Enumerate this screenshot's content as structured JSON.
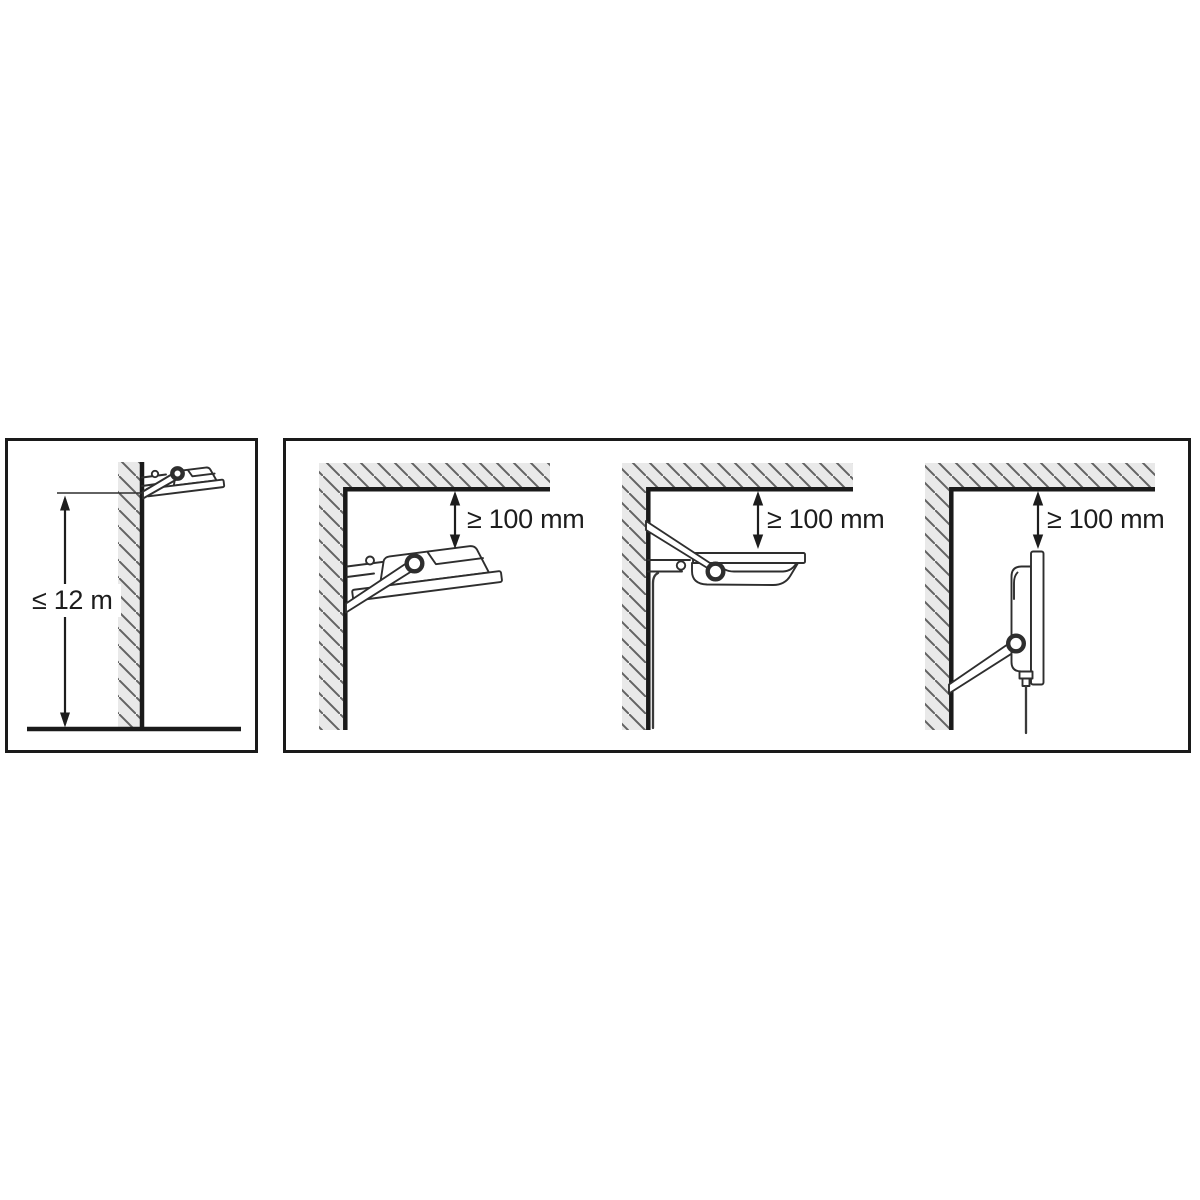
{
  "diagram": {
    "type": "floodlight-installation-clearance-diagram",
    "colors": {
      "background": "#ffffff",
      "outline": "#1a1a1a",
      "drawing_line": "#2e2e2e",
      "wall_fill": "#e9e9e9",
      "hatch_line": "#636363",
      "text": "#1d1d1d"
    },
    "left_panel": {
      "description": "side view of floodlight mounted at top of a wall with maximum mounting height above ground",
      "dimension_label": "≤ 12 m"
    },
    "right_panel": {
      "description": "three wall-corner figures showing minimum clearance between floodlight and ceiling",
      "figures": [
        {
          "orientation": "floodlight-angled-upward",
          "clearance_label": "≥ 100 mm"
        },
        {
          "orientation": "floodlight-horizontal-facing-down",
          "clearance_label": "≥ 100 mm"
        },
        {
          "orientation": "floodlight-vertical-facing-outward",
          "clearance_label": "≥ 100 mm"
        }
      ]
    }
  }
}
